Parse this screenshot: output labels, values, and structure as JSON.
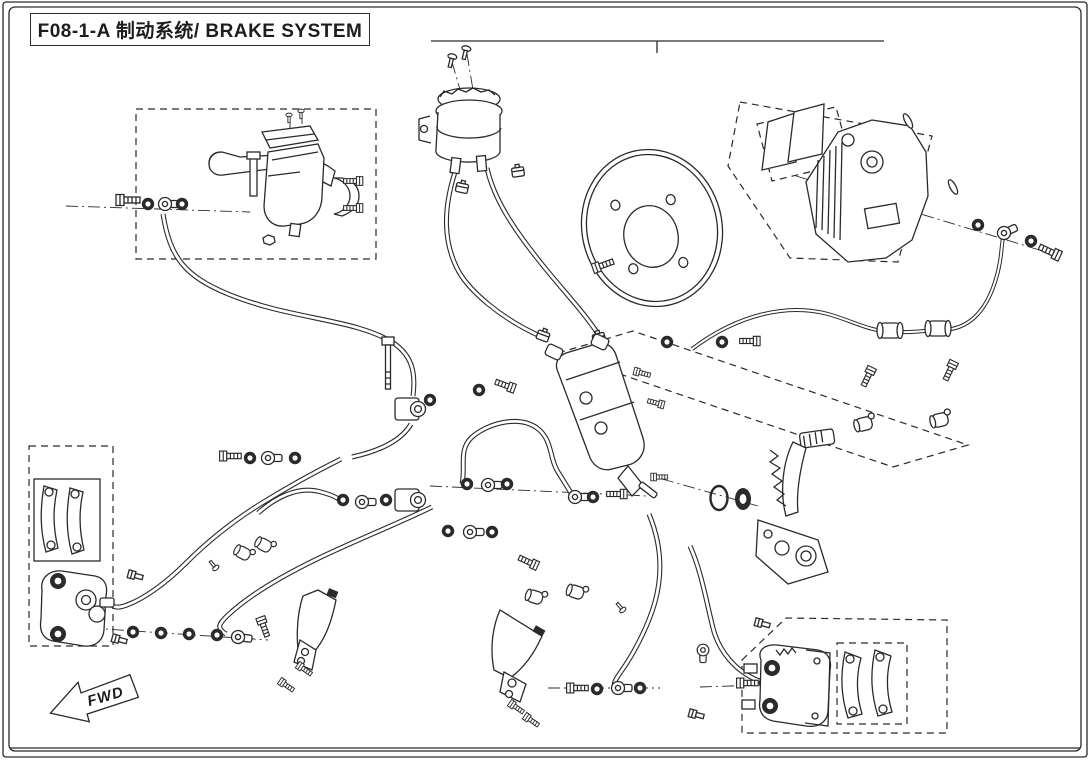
{
  "title": {
    "text": "F08-1-A 制动系统/ BRAKE SYSTEM"
  },
  "top_index": {
    "numbers": [
      "2",
      "3",
      "4",
      "5",
      "6",
      "8",
      "9",
      "10",
      "11",
      "14",
      "15",
      "18",
      "19",
      "20",
      "22",
      "23",
      "28",
      "32",
      "34",
      "35",
      "36"
    ],
    "assembly_label": "1"
  },
  "fwd_marker": {
    "label": "FWD"
  },
  "colors": {
    "line": "#2a2a2a",
    "bg": "#ffffff"
  },
  "callouts": [
    {
      "label": "1",
      "x": 657,
      "y": 65,
      "targets": [
        [
          657,
          44
        ]
      ]
    },
    {
      "label": "2",
      "x": 134,
      "y": 74,
      "targets": [
        [
          152,
          107
        ]
      ]
    },
    {
      "label": "3",
      "x": 166,
      "y": 124,
      "targets": [
        [
          178,
          158
        ]
      ]
    },
    {
      "label": "4",
      "x": 108,
      "y": 166,
      "targets": [
        [
          120,
          196
        ]
      ]
    },
    {
      "label": "5",
      "x": 146,
      "y": 240,
      "targets": [
        [
          148,
          211
        ]
      ]
    },
    {
      "label": "5",
      "x": 196,
      "y": 240,
      "targets": [
        [
          184,
          211
        ]
      ]
    },
    {
      "label": "6",
      "x": 145,
      "y": 290,
      "targets": [
        [
          180,
          277
        ]
      ]
    },
    {
      "label": "7",
      "x": 404,
      "y": 62,
      "targets": [
        [
          447,
          63
        ],
        [
          461,
          56
        ]
      ]
    },
    {
      "label": "8",
      "x": 401,
      "y": 127,
      "targets": [
        [
          436,
          128
        ]
      ]
    },
    {
      "label": "9",
      "x": 403,
      "y": 183,
      "targets": [
        [
          456,
          189
        ]
      ]
    },
    {
      "label": "9",
      "x": 557,
      "y": 150,
      "targets": [
        [
          524,
          172
        ]
      ]
    },
    {
      "label": "9",
      "x": 499,
      "y": 325,
      "targets": [
        [
          538,
          336
        ]
      ]
    },
    {
      "label": "9",
      "x": 633,
      "y": 313,
      "targets": [
        [
          604,
          338
        ]
      ]
    },
    {
      "label": "10",
      "x": 448,
      "y": 265,
      "targets": [
        [
          468,
          254
        ]
      ]
    },
    {
      "label": "11",
      "x": 577,
      "y": 222,
      "targets": [
        [
          548,
          238
        ]
      ]
    },
    {
      "label": "12",
      "x": 613,
      "y": 289,
      "targets": [
        [
          603,
          273
        ]
      ]
    },
    {
      "label": "13",
      "x": 631,
      "y": 125,
      "targets": [
        [
          645,
          162
        ]
      ]
    },
    {
      "label": "14",
      "x": 758,
      "y": 75,
      "targets": [
        [
          785,
          106
        ]
      ]
    },
    {
      "label": "15",
      "x": 806,
      "y": 298,
      "targets": [
        [
          822,
          268
        ]
      ]
    },
    {
      "label": "16",
      "x": 954,
      "y": 143,
      "targets": [
        [
          914,
          126
        ]
      ]
    },
    {
      "label": "17",
      "x": 992,
      "y": 120,
      "targets": [
        [
          936,
          113
        ],
        [
          956,
          178
        ]
      ]
    },
    {
      "label": "5",
      "x": 1047,
      "y": 201,
      "targets": [
        [
          978,
          224
        ],
        [
          1030,
          240
        ]
      ]
    },
    {
      "label": "4",
      "x": 1060,
      "y": 300,
      "targets": [
        [
          1053,
          262
        ]
      ]
    },
    {
      "label": "21",
      "x": 841,
      "y": 368,
      "targets": [
        [
          866,
          376
        ]
      ]
    },
    {
      "label": "21",
      "x": 977,
      "y": 361,
      "targets": [
        [
          950,
          372
        ]
      ]
    },
    {
      "label": "22",
      "x": 908,
      "y": 412,
      "targets": [
        [
          866,
          423
        ],
        [
          940,
          419
        ]
      ]
    },
    {
      "label": "23",
      "x": 819,
      "y": 404,
      "targets": [
        [
          800,
          362
        ]
      ]
    },
    {
      "label": "24",
      "x": 848,
      "y": 462,
      "targets": [
        [
          826,
          452
        ]
      ]
    },
    {
      "label": "25",
      "x": 747,
      "y": 475,
      "targets": [
        [
          777,
          468
        ]
      ]
    },
    {
      "label": "27",
      "x": 722,
      "y": 545,
      "targets": [
        [
          720,
          512
        ]
      ]
    },
    {
      "label": "26",
      "x": 744,
      "y": 545,
      "targets": [
        [
          744,
          512
        ]
      ]
    },
    {
      "label": "28",
      "x": 692,
      "y": 427,
      "targets": [
        [
          648,
          424
        ]
      ]
    },
    {
      "label": "29",
      "x": 684,
      "y": 380,
      "targets": [
        [
          643,
          374
        ],
        [
          661,
          401
        ]
      ]
    },
    {
      "label": "30",
      "x": 482,
      "y": 414,
      "targets": [
        [
          500,
          432
        ]
      ]
    },
    {
      "label": "31",
      "x": 351,
      "y": 362,
      "targets": [
        [
          383,
          366
        ]
      ]
    },
    {
      "label": "32",
      "x": 435,
      "y": 452,
      "targets": [
        [
          414,
          421
        ],
        [
          414,
          494
        ]
      ]
    },
    {
      "label": "5",
      "x": 424,
      "y": 363,
      "targets": [
        [
          430,
          396
        ]
      ]
    },
    {
      "label": "5",
      "x": 485,
      "y": 354,
      "targets": [
        [
          480,
          386
        ]
      ]
    },
    {
      "label": "4",
      "x": 513,
      "y": 353,
      "targets": [
        [
          509,
          383
        ]
      ]
    },
    {
      "label": "5",
      "x": 695,
      "y": 303,
      "targets": [
        [
          668,
          338
        ],
        [
          722,
          338
        ]
      ]
    },
    {
      "label": "4",
      "x": 745,
      "y": 301,
      "targets": [
        [
          752,
          337
        ]
      ]
    },
    {
      "label": "34",
      "x": 80,
      "y": 458,
      "targets": [
        [
          60,
          479
        ]
      ]
    },
    {
      "label": "18",
      "x": 137,
      "y": 475,
      "targets": [
        [
          115,
          482
        ]
      ]
    },
    {
      "label": "33",
      "x": 147,
      "y": 540,
      "targets": [
        [
          135,
          571
        ]
      ]
    },
    {
      "label": "20",
      "x": 211,
      "y": 478,
      "targets": [
        [
          235,
          500
        ]
      ]
    },
    {
      "label": "19",
      "x": 322,
      "y": 462,
      "targtargets": null,
      "targets": [
        [
          305,
          490
        ]
      ]
    },
    {
      "label": "22",
      "x": 237,
      "y": 539,
      "targets": [
        [
          248,
          551
        ]
      ]
    },
    {
      "label": "22",
      "x": 237,
      "y": 579,
      "targets": [
        [
          252,
          560
        ]
      ]
    },
    {
      "label": "37",
      "x": 196,
      "y": 580,
      "targets": [
        [
          212,
          571
        ]
      ]
    },
    {
      "label": "20",
      "x": 330,
      "y": 565,
      "targets": [
        [
          312,
          556
        ]
      ]
    },
    {
      "label": "5",
      "x": 362,
      "y": 461,
      "targets": [
        [
          344,
          498
        ],
        [
          386,
          498
        ]
      ]
    },
    {
      "label": "4",
      "x": 231,
      "y": 417,
      "targets": [
        [
          228,
          452
        ]
      ]
    },
    {
      "label": "5",
      "x": 273,
      "y": 412,
      "targets": [
        [
          252,
          452
        ],
        [
          294,
          452
        ]
      ]
    },
    {
      "label": "5",
      "x": 138,
      "y": 646,
      "targets": [
        [
          133,
          638
        ]
      ]
    },
    {
      "label": "4",
      "x": 176,
      "y": 646,
      "targets": [
        [
          172,
          639
        ]
      ]
    },
    {
      "label": "5",
      "x": 213,
      "y": 650,
      "targets": [
        [
          214,
          641
        ]
      ]
    },
    {
      "label": "4",
      "x": 259,
      "y": 650,
      "targets": [
        [
          262,
          628
        ]
      ]
    },
    {
      "label": "33",
      "x": 130,
      "y": 667,
      "targets": [
        [
          119,
          645
        ]
      ]
    },
    {
      "label": "38",
      "x": 352,
      "y": 628,
      "targets": [
        [
          332,
          616
        ]
      ]
    },
    {
      "label": "39",
      "x": 458,
      "y": 653,
      "targets": [
        [
          496,
          638
        ]
      ]
    },
    {
      "label": "21",
      "x": 299,
      "y": 723,
      "targets": [
        [
          288,
          692
        ],
        [
          306,
          676
        ]
      ]
    },
    {
      "label": "21",
      "x": 496,
      "y": 721,
      "targets": [
        [
          516,
          712
        ],
        [
          531,
          724
        ]
      ]
    },
    {
      "label": "4",
      "x": 567,
      "y": 721,
      "targets": [
        [
          574,
          694
        ]
      ]
    },
    {
      "label": "5",
      "x": 616,
      "y": 721,
      "targets": [
        [
          598,
          695
        ],
        [
          639,
          694
        ]
      ]
    },
    {
      "label": "33",
      "x": 666,
      "y": 703,
      "targets": [
        [
          690,
          713
        ]
      ]
    },
    {
      "label": "5",
      "x": 470,
      "y": 544,
      "targets": [
        [
          449,
          537
        ],
        [
          491,
          538
        ]
      ]
    },
    {
      "label": "4",
      "x": 550,
      "y": 584,
      "targets": [
        [
          534,
          568
        ]
      ]
    },
    {
      "label": "22",
      "x": 600,
      "y": 628,
      "targets": [
        [
          537,
          600
        ],
        [
          576,
          596
        ]
      ]
    },
    {
      "label": "37",
      "x": 627,
      "y": 637,
      "targets": [
        [
          624,
          618
        ]
      ]
    },
    {
      "label": "36",
      "x": 650,
      "y": 647,
      "targets": [
        [
          698,
          649
        ]
      ]
    },
    {
      "label": "4",
      "x": 650,
      "y": 668,
      "targets": [
        [
          739,
          681
        ]
      ]
    },
    {
      "label": "5",
      "x": 696,
      "y": 670,
      "targets": [
        [
          762,
          681
        ]
      ]
    },
    {
      "label": "33",
      "x": 737,
      "y": 598,
      "targets": [
        [
          759,
          621
        ]
      ]
    },
    {
      "label": "35",
      "x": 888,
      "y": 583,
      "targets": [
        [
          868,
          618
        ]
      ]
    },
    {
      "label": "34",
      "x": 932,
      "y": 635,
      "targets": [
        [
          908,
          650
        ]
      ]
    },
    {
      "label": "5",
      "x": 506,
      "y": 512,
      "targets": [
        [
          468,
          490
        ],
        [
          507,
          490
        ]
      ]
    },
    {
      "label": "5",
      "x": 614,
      "y": 518,
      "targets": [
        [
          594,
          503
        ]
      ]
    },
    {
      "label": "4",
      "x": 641,
      "y": 523,
      "targets": [
        [
          622,
          500
        ]
      ]
    }
  ]
}
